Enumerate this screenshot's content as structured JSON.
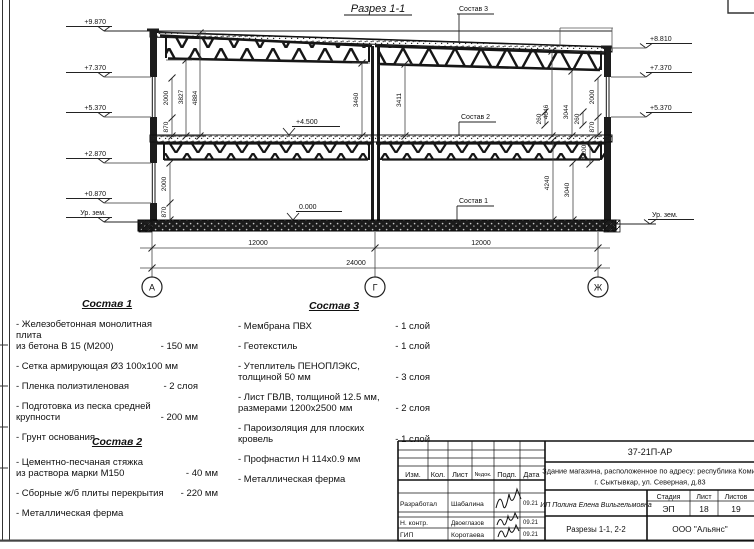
{
  "title": "Разрез 1-1",
  "labels": {
    "sostav1": "Состав 1",
    "sostav2": "Состав 2",
    "sostav3": "Состав 3"
  },
  "elev": {
    "l1": "+9.870",
    "l2": "+7.370",
    "l3": "+5.370",
    "l4": "+2.870",
    "l5": "+0.870",
    "l6": "Ур. зем.",
    "r1": "+8.810",
    "r2": "+7.370",
    "r3": "+5.370",
    "r4": "Ур. зем.",
    "f45": "+4.500",
    "f0": "0.000"
  },
  "dims": {
    "w2000a": "2000",
    "d3827": "3827",
    "d4884": "4884",
    "w870a": "870",
    "d3460": "3460",
    "d3411": "3411",
    "d4046": "4046",
    "d3044": "3044",
    "w2000b": "2000",
    "d260a": "260",
    "d260b": "260",
    "w870b": "870",
    "w2000c": "2000",
    "w870c": "870",
    "d4240": "4240",
    "d3040": "3040",
    "d1200": "1200",
    "span1": "12000",
    "span2": "12000",
    "total": "24000"
  },
  "axes": {
    "a1": "А",
    "a2": "Г",
    "a3": "Ж"
  },
  "compositions": [
    {
      "title": "Состав 1",
      "items": [
        {
          "name": "- Железобетонная монолитная плита\nиз бетона В 15 (М200)",
          "value": "- 150 мм"
        },
        {
          "name": "- Сетка армирующая Ø3 100x100 мм",
          "value": ""
        },
        {
          "name": "- Пленка полиэтиленовая",
          "value": "- 2 слоя"
        },
        {
          "name": "- Подготовка из песка средней\nкрупности",
          "value": "- 200 мм"
        },
        {
          "name": "- Грунт основания",
          "value": ""
        }
      ]
    },
    {
      "title": "Состав 2",
      "items": [
        {
          "name": "- Цементно-песчаная стяжка\nиз раствора марки М150",
          "value": "- 40 мм"
        },
        {
          "name": "- Сборные ж/б плиты перекрытия",
          "value": "- 220 мм"
        },
        {
          "name": "- Металлическая ферма",
          "value": ""
        }
      ]
    },
    {
      "title": "Состав 3",
      "items": [
        {
          "name": "- Мембрана ПВХ",
          "value": "- 1 слой"
        },
        {
          "name": "- Геотекстиль",
          "value": "- 1 слой"
        },
        {
          "name": "- Утеплитель ПЕНОПЛЭКС,\nтолщиной 50 мм",
          "value": "- 3 слоя"
        },
        {
          "name": "- Лист ГВЛВ, толщиной 12.5 мм,\nразмерами 1200x2500 мм",
          "value": "- 2 слоя"
        },
        {
          "name": "- Пароизоляция для плоских кровель",
          "value": "- 1 слой"
        },
        {
          "name": "- Профнастил Н 114x0.9 мм",
          "value": ""
        },
        {
          "name": "- Металлическая ферма",
          "value": ""
        }
      ]
    }
  ],
  "titleblock": {
    "doc_number": "37-21П-АР",
    "project_line1": "Здание магазина, расположенное по адресу: республика Коми,",
    "project_line2": "г. Сыктывкар, ул. Северная, д.83",
    "header": {
      "izm": "Изм.",
      "kol": "Кол.",
      "list": "Лист",
      "ndok": "№док.",
      "podp": "Подп.",
      "data": "Дата"
    },
    "rows": [
      {
        "role": "Разработал",
        "name": "Шабалина",
        "date": "09.21"
      },
      {
        "role": "Н. контр.",
        "name": "Двоеглазов",
        "date": "09.21"
      },
      {
        "role": "ГИП",
        "name": "Коротаева",
        "date": "09.21"
      }
    ],
    "client": "ИП Полина Елена Вильгельмовна",
    "stage_label": "Стадия",
    "sheet_label": "Лист",
    "sheets_label": "Листов",
    "stage": "ЭП",
    "sheet_no": "18",
    "sheets_total": "19",
    "drawing_name": "Разрезы 1-1, 2-2",
    "company": "ООО \"Альянс\""
  }
}
